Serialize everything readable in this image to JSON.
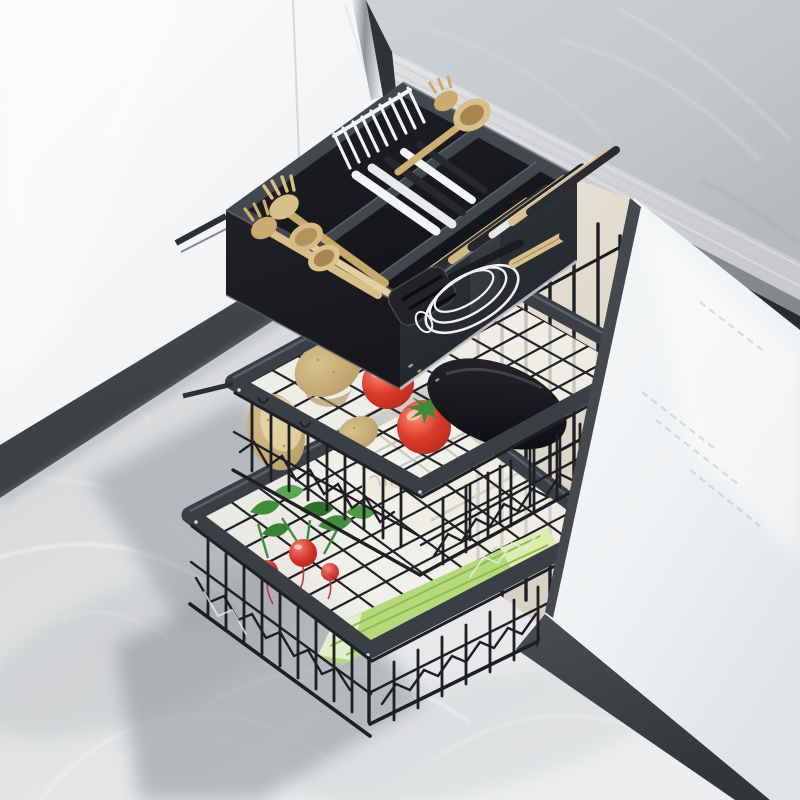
{
  "scene": {
    "type": "product-photo",
    "subject": "three-tier-pullout-cabinet-organizer",
    "setting": "kitchen-with-marble-floor-white-cabinets-stone-countertop",
    "tiers": [
      {
        "name": "cutlery-drawer",
        "contents": [
          "wooden-forks",
          "wooden-spoons",
          "steel-forks",
          "dark-utensils",
          "slotted-turner",
          "balloon-whisk"
        ]
      },
      {
        "name": "middle-wire-basket",
        "contents": [
          "potatoes",
          "tomatoes",
          "eggplant"
        ]
      },
      {
        "name": "bottom-wire-basket",
        "contents": [
          "radishes",
          "radish-leaves",
          "garlic",
          "leek"
        ]
      }
    ]
  },
  "palette": {
    "floor_light": "#eceeef",
    "floor_mid": "#d8dadc",
    "floor_dark": "#c2c5c9",
    "vein_white": "#ffffff",
    "shadow": "#878c93",
    "cabinet_white": "#fbfcfd",
    "cabinet_shade": "#e3e6e9",
    "seam": "#d2d5d9",
    "trim_light": "#eef0f2",
    "trim_dark": "#8e9299",
    "gap_dark": "#2f3236",
    "toekick": "#4c4f55",
    "toekick_dark": "#3a3d42",
    "counter_light": "#cfd2d6",
    "counter_dark": "#b6b9be",
    "counter_edge": "#e0e1e3",
    "counter_edge_shade": "#c8cacd",
    "counter_strip": "#85888d",
    "counter_strip_dark": "#292b2f",
    "cream": "#ece7db",
    "cream_shade": "#d7d1c3",
    "door_white": "#f6f8f9",
    "door_shade": "#e1e4e7",
    "plinth": "#4a4d53",
    "plinth_dark": "#323539",
    "door_edge": "#45484d",
    "wire": "#1e2024",
    "wire_light": "#eaebec",
    "frame": "#3b3f45",
    "frame_hi": "#676d75",
    "tray_top": "#43474e",
    "tray_int_dark": "#141518",
    "tray_face_left": "#1f2125",
    "tray_face_right": "#34373d",
    "divider": "#41454c",
    "divider_hi": "#5c616a",
    "wood": "#d9bf8a",
    "wood_dark": "#b3945c",
    "wood_deep": "#8f6f3d",
    "steel": "#f3f4f6",
    "steel_shade": "#c3c7cc",
    "utensil_dark": "#26282d",
    "whisk_wire": "#f1f2f4",
    "potato": "#d9c28c",
    "potato_dark": "#b2945f",
    "potato_flesh": "#ead9a9",
    "tomato": "#db3a2a",
    "tomato_dark": "#a62418",
    "tomato_hi": "#ff8d76",
    "tomato_stem": "#3f8a34",
    "eggplant": "#26262d",
    "eggplant_deep": "#0f0f13",
    "garlic": "#f0ebdf",
    "garlic_line": "#c9c0ad",
    "radish": "#d5342b",
    "radish_hi": "#f08276",
    "radish_leaf": "#3f8f3a",
    "radish_leaf_dark": "#2e7029",
    "leek": "#b5da7c",
    "leek_stripe": "#8cbd4e",
    "leek_tip": "#dcedae",
    "backing": "#f3f1ea",
    "rail_gray": "#b9bcc0"
  }
}
